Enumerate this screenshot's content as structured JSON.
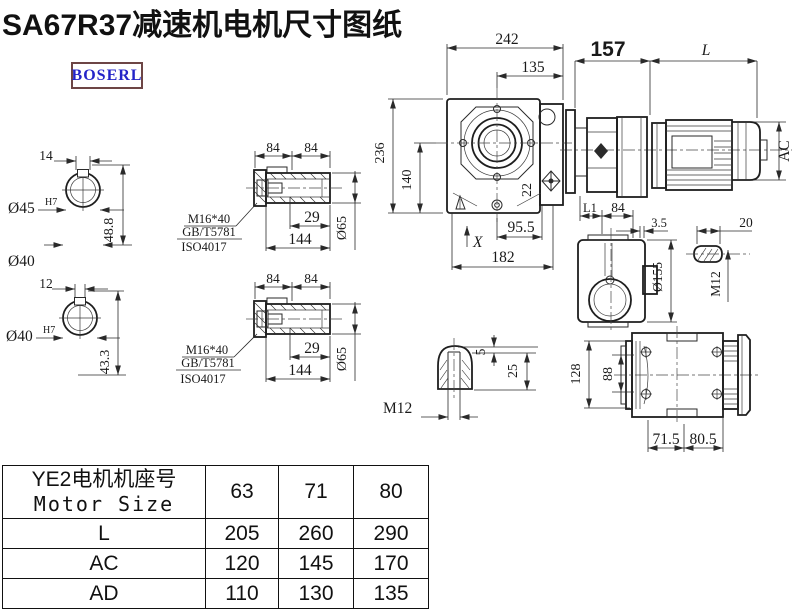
{
  "title": "SA67R37减速机电机尺寸图纸",
  "logo": "BOSERL",
  "colors": {
    "line": "#2a2a2a",
    "logo_text": "#2424c8",
    "logo_border": "#6d4545",
    "accent": "#111111"
  },
  "dims": {
    "shaft_a": {
      "key_width": "14",
      "bore": "Ø45",
      "fit": "H7",
      "height": "48.8",
      "od": "Ø40"
    },
    "shaft_b": {
      "key_width": "12",
      "bore": "Ø40",
      "fit": "H7",
      "height": "43.3"
    },
    "hollow_a": {
      "seg1": "84",
      "seg2": "84",
      "bolt": "M16*40",
      "std1": "GB/T5781",
      "std2": "ISO4017",
      "depth": "29",
      "length": "144",
      "dia": "Ø65"
    },
    "hollow_b": {
      "seg1": "84",
      "seg2": "84",
      "bolt": "M16*40",
      "std1": "GB/T5781",
      "std2": "ISO4017",
      "depth": "29",
      "length": "144",
      "dia": "Ø65"
    },
    "front": {
      "width": "242",
      "center_to_face": "135",
      "height": "236",
      "center_height": "140",
      "hole": "22",
      "foot": "95.5",
      "base": "182",
      "mark": "X"
    },
    "motor": {
      "gear_length": "157",
      "motor_length": "L",
      "motor_dia": "AC"
    },
    "side": {
      "l1": "L1",
      "w": "84",
      "flange": "3.5",
      "key_len": "20",
      "dia": "Ø155",
      "tap": "M12"
    },
    "key_detail": {
      "depth": "5",
      "height": "25",
      "tap": "M12"
    },
    "bottom": {
      "height": "128",
      "inner": "88",
      "foot1": "71.5",
      "foot2": "80.5"
    }
  },
  "table": {
    "header_cn": "YE2电机机座号",
    "header_en": "Motor Size",
    "sizes": [
      "63",
      "71",
      "80"
    ],
    "rows": [
      {
        "label": "L",
        "values": [
          "205",
          "260",
          "290"
        ]
      },
      {
        "label": "AC",
        "values": [
          "120",
          "145",
          "170"
        ]
      },
      {
        "label": "AD",
        "values": [
          "110",
          "130",
          "135"
        ]
      }
    ]
  }
}
